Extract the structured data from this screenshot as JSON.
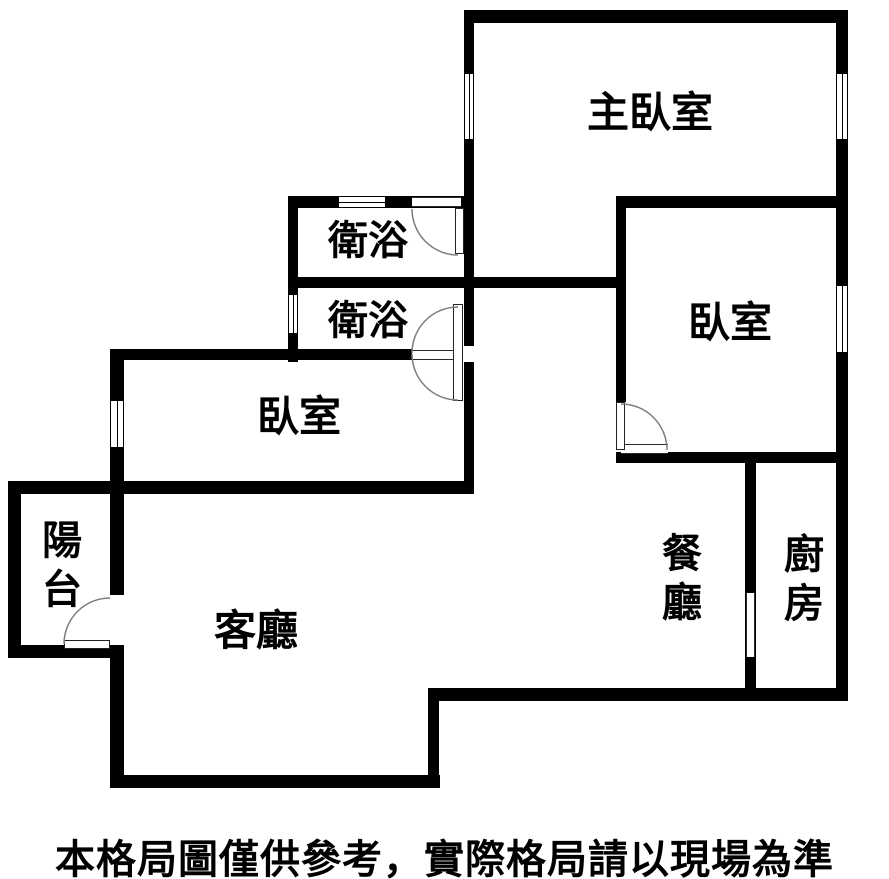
{
  "floorplan": {
    "rooms": {
      "master_bedroom": {
        "label": "主臥室"
      },
      "bathroom_top": {
        "label": "衛浴"
      },
      "bathroom_bottom": {
        "label": "衛浴"
      },
      "bedroom_left": {
        "label": "臥室"
      },
      "bedroom_right": {
        "label": "臥室"
      },
      "balcony": {
        "label": "陽台"
      },
      "living_room": {
        "label": "客廳"
      },
      "dining_room": {
        "label": "餐廳"
      },
      "kitchen": {
        "label": "廚房"
      }
    },
    "caption": "本格局圖僅供參考，實際格局請以現場為準",
    "colors": {
      "wall": "#000000",
      "background": "#ffffff",
      "door_arc": "#7d7d7d",
      "text": "#000000"
    }
  }
}
